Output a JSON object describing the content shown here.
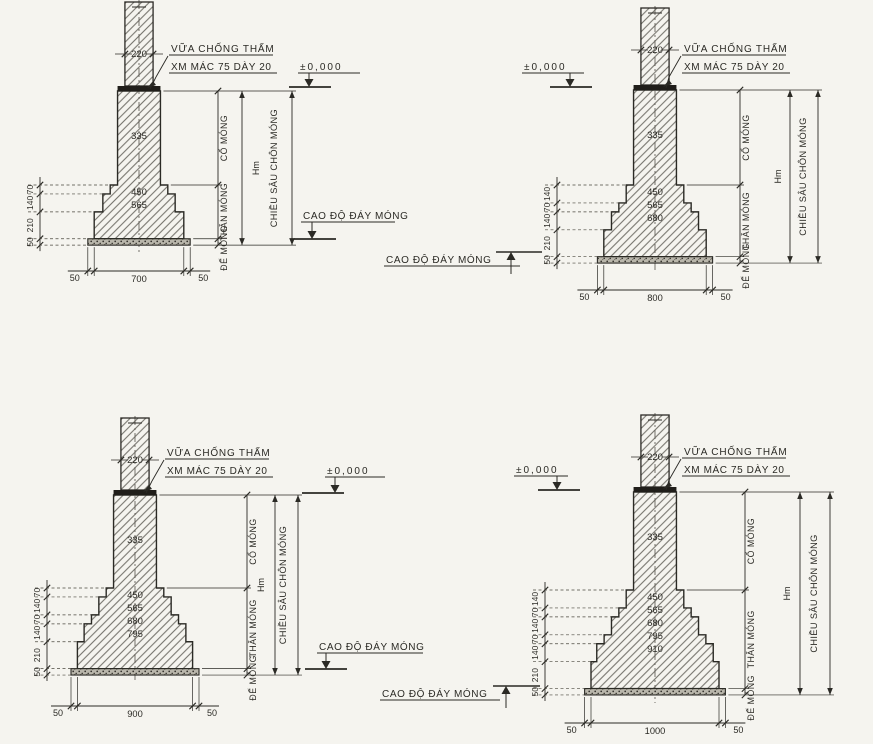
{
  "sheet": {
    "kind": "foundation-detail-drawing",
    "ink_color": "#2b2a25",
    "paper_color": "#f5f4ef"
  },
  "common": {
    "waterproof_note": [
      "VỮA CHỐNG THẤM",
      "XM MÁC 75 DÀY 20"
    ],
    "ground_level_label": "±0,000",
    "footing_bottom_label": "CAO ĐỘ ĐÁY MÓNG",
    "section_labels": [
      "CỔ MÓNG",
      "THÂN MÓNG",
      "ĐẾ MÓNG"
    ],
    "depth_symbol": "Hm",
    "depth_label": "CHIỀU SÂU CHÔN MÓNG",
    "column_width": 220,
    "neck_width": 335,
    "overhang": 50
  },
  "details": [
    {
      "name": "footing-700",
      "base_width": 700,
      "step_widths": [
        450,
        565
      ],
      "step_heights": [
        70,
        140
      ],
      "base_height": 210,
      "bedding_thickness": 50,
      "left_dims": [
        "70",
        "140",
        "210",
        "50"
      ],
      "bottom_dims": [
        "50",
        "700",
        "50"
      ]
    },
    {
      "name": "footing-800",
      "base_width": 800,
      "step_widths": [
        450,
        565,
        680
      ],
      "step_heights": [
        140,
        70,
        140
      ],
      "base_height": 210,
      "bedding_thickness": 50,
      "left_dims": [
        "140",
        "70",
        "140",
        "210",
        "50"
      ],
      "bottom_dims": [
        "50",
        "800",
        "50"
      ]
    },
    {
      "name": "footing-900",
      "base_width": 900,
      "step_widths": [
        450,
        565,
        680,
        795
      ],
      "step_heights": [
        70,
        140,
        70,
        140
      ],
      "base_height": 210,
      "bedding_thickness": 50,
      "left_dims": [
        "70",
        "140",
        "70",
        "140",
        "210",
        "50"
      ],
      "bottom_dims": [
        "50",
        "900",
        "50"
      ]
    },
    {
      "name": "footing-1000",
      "base_width": 1000,
      "step_widths": [
        450,
        565,
        680,
        795,
        910
      ],
      "step_heights": [
        140,
        70,
        140,
        70,
        140
      ],
      "base_height": 210,
      "bedding_thickness": 50,
      "left_dims": [
        "140",
        "70",
        "140",
        "70",
        "140",
        "210",
        "50"
      ],
      "bottom_dims": [
        "50",
        "1000",
        "50"
      ]
    }
  ]
}
